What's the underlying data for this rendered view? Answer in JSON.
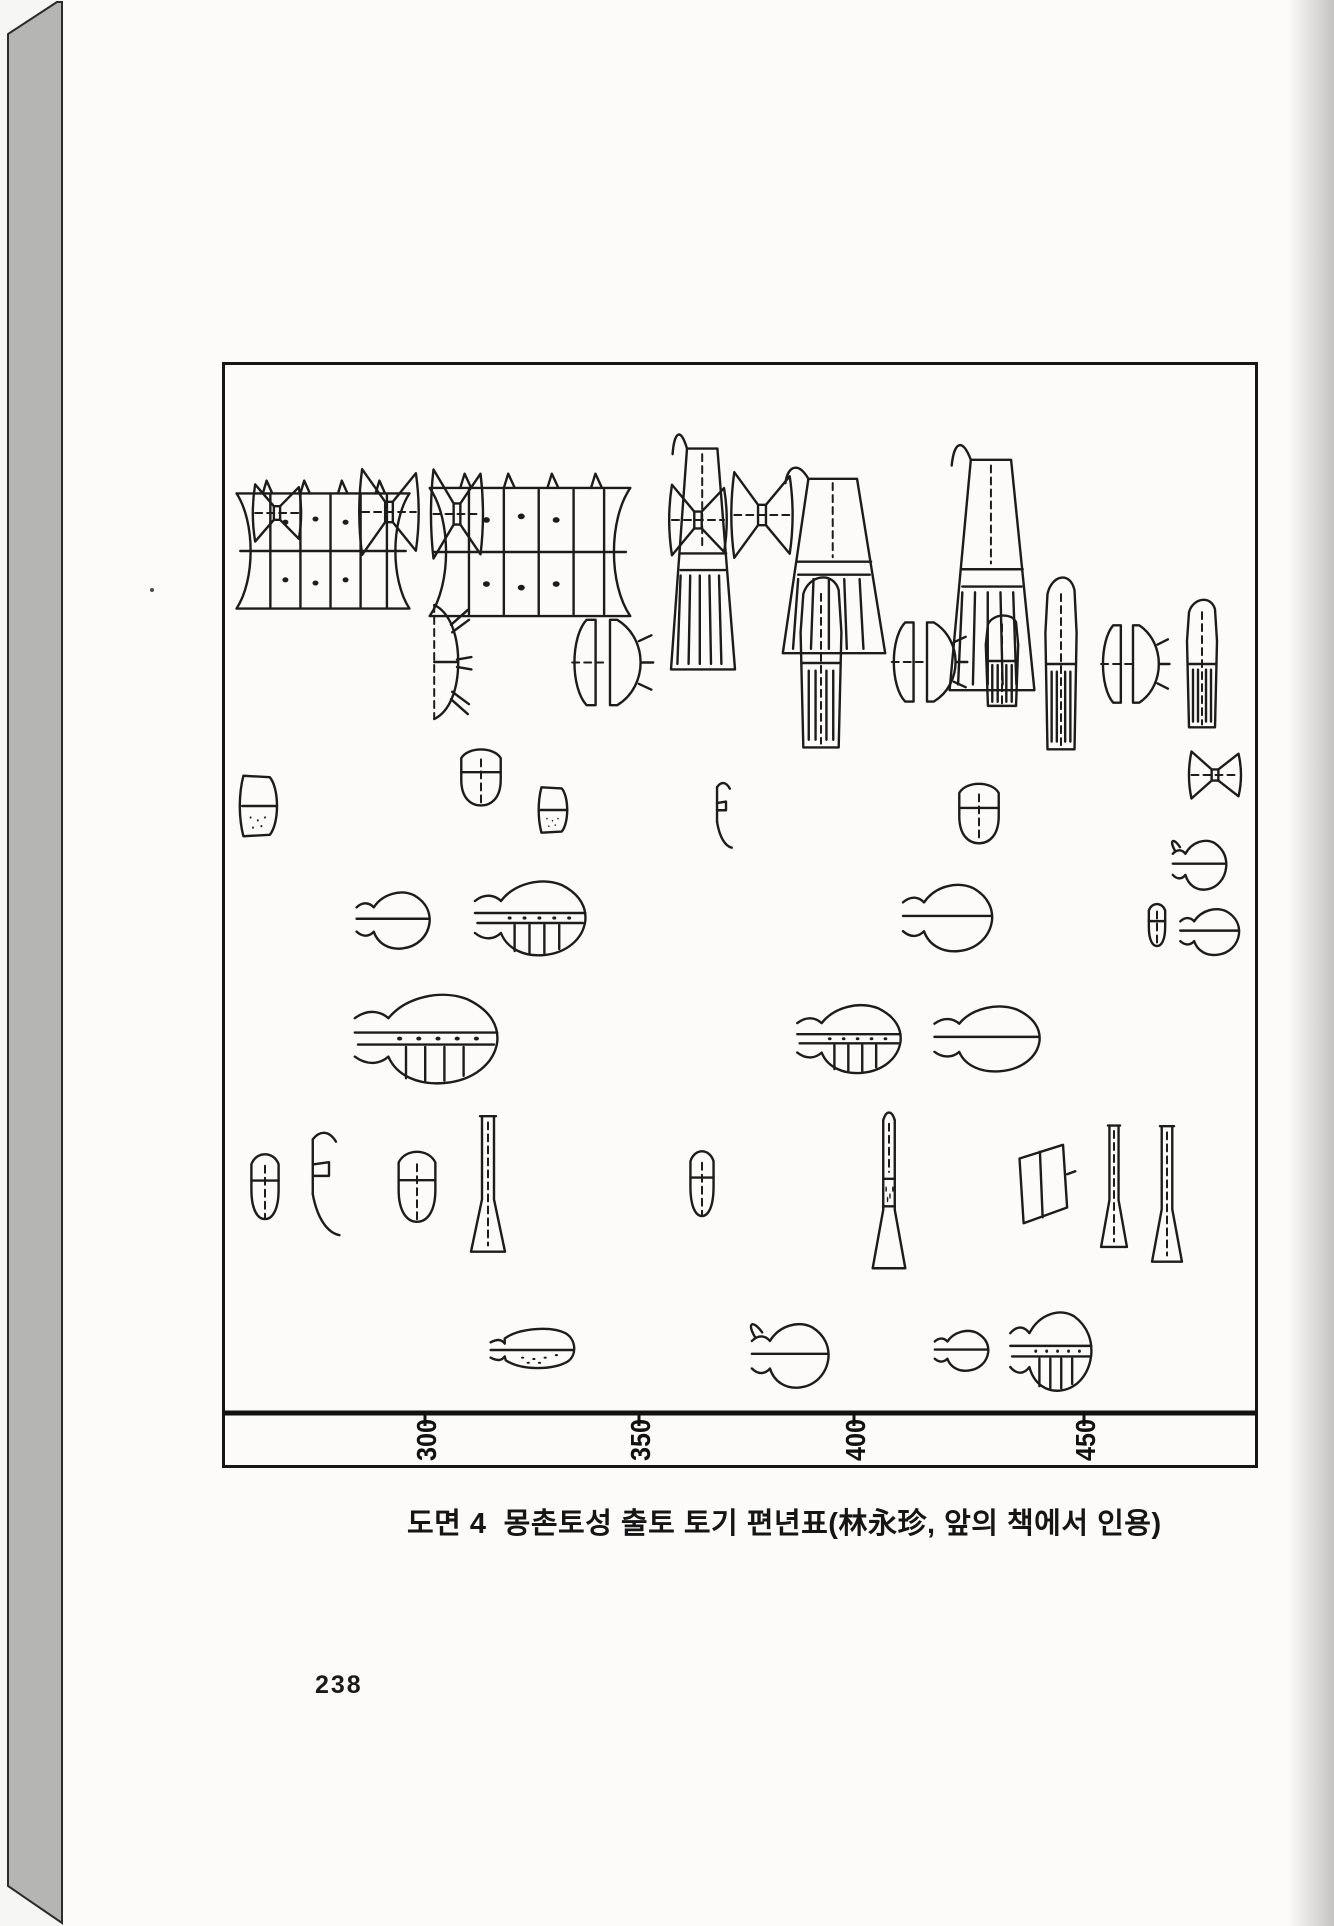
{
  "page": {
    "number": "238"
  },
  "figure": {
    "caption": "도면 4  몽촌토성 출토 토기 편년표(林永珍, 앞의 책에서 인용)",
    "axis": {
      "tick_labels": [
        "300",
        "350",
        "400",
        "450"
      ],
      "tick_x": [
        200,
        414,
        629,
        859
      ],
      "baseline_y": 1048,
      "tick_length": 13
    },
    "box": {
      "left": 222,
      "top": 362,
      "width": 1030,
      "height": 1100
    },
    "items": [
      {
        "t": "stand_long",
        "x": 4,
        "y": 106,
        "w": 188,
        "h": 160
      },
      {
        "t": "stand_long",
        "x": 196,
        "y": 98,
        "w": 218,
        "h": 178
      },
      {
        "t": "stand_cone",
        "x": 438,
        "y": 56,
        "w": 80,
        "h": 276
      },
      {
        "t": "stand_cone",
        "x": 545,
        "y": 92,
        "w": 128,
        "h": 218
      },
      {
        "t": "stand_cone",
        "x": 714,
        "y": 66,
        "w": 106,
        "h": 288
      },
      {
        "t": "goblet_bow",
        "x": 26,
        "y": 114,
        "w": 52,
        "h": 68
      },
      {
        "t": "goblet_bow",
        "x": 132,
        "y": 96,
        "w": 64,
        "h": 102
      },
      {
        "t": "goblet_bow",
        "x": 204,
        "y": 96,
        "w": 56,
        "h": 106
      },
      {
        "t": "goblet_bow",
        "x": 442,
        "y": 113,
        "w": 62,
        "h": 84
      },
      {
        "t": "goblet_bow",
        "x": 504,
        "y": 99,
        "w": 66,
        "h": 102
      },
      {
        "t": "dish_struts",
        "x": 190,
        "y": 235,
        "w": 60,
        "h": 124
      },
      {
        "t": "dish_half_pair",
        "x": 340,
        "y": 249,
        "w": 90,
        "h": 97
      },
      {
        "t": "deep_cyl",
        "x": 562,
        "y": 202,
        "w": 68,
        "h": 192
      },
      {
        "t": "dish_half_pair",
        "x": 660,
        "y": 252,
        "w": 84,
        "h": 90
      },
      {
        "t": "deep_cyl",
        "x": 750,
        "y": 245,
        "w": 54,
        "h": 102
      },
      {
        "t": "deep_cyl",
        "x": 810,
        "y": 202,
        "w": 52,
        "h": 194
      },
      {
        "t": "dish_half_pair",
        "x": 870,
        "y": 255,
        "w": 76,
        "h": 88
      },
      {
        "t": "deep_cyl",
        "x": 952,
        "y": 227,
        "w": 50,
        "h": 144
      },
      {
        "t": "goblet_bow",
        "x": 962,
        "y": 382,
        "w": 56,
        "h": 56
      },
      {
        "t": "bowl_hatch",
        "x": 10,
        "y": 405,
        "w": 60,
        "h": 72
      },
      {
        "t": "bowl_cup",
        "x": 227,
        "y": 379,
        "w": 58,
        "h": 64
      },
      {
        "t": "bowl_hatch",
        "x": 310,
        "y": 418,
        "w": 46,
        "h": 54
      },
      {
        "t": "lid_hook",
        "x": 485,
        "y": 415,
        "w": 32,
        "h": 72
      },
      {
        "t": "bowl_cup",
        "x": 725,
        "y": 413,
        "w": 58,
        "h": 68
      },
      {
        "t": "jar_handle",
        "x": 943,
        "y": 465,
        "w": 60,
        "h": 66
      },
      {
        "t": "jar_neck",
        "x": 125,
        "y": 515,
        "w": 82,
        "h": 76
      },
      {
        "t": "jar_hatched",
        "x": 240,
        "y": 500,
        "w": 124,
        "h": 100
      },
      {
        "t": "jar_neck",
        "x": 670,
        "y": 505,
        "w": 100,
        "h": 90
      },
      {
        "t": "bowl_cup",
        "x": 920,
        "y": 535,
        "w": 24,
        "h": 48
      },
      {
        "t": "jar_neck",
        "x": 950,
        "y": 534,
        "w": 66,
        "h": 62
      },
      {
        "t": "jar_hatched",
        "x": 117,
        "y": 610,
        "w": 160,
        "h": 120
      },
      {
        "t": "jar_hatched",
        "x": 563,
        "y": 625,
        "w": 116,
        "h": 92
      },
      {
        "t": "jar_neck",
        "x": 700,
        "y": 627,
        "w": 118,
        "h": 88
      },
      {
        "t": "bowl_cup",
        "x": 20,
        "y": 783,
        "w": 40,
        "h": 74
      },
      {
        "t": "lid_hook",
        "x": 75,
        "y": 763,
        "w": 58,
        "h": 114
      },
      {
        "t": "bowl_cup",
        "x": 165,
        "y": 780,
        "w": 54,
        "h": 80
      },
      {
        "t": "pedestal_flare",
        "x": 238,
        "y": 745,
        "w": 50,
        "h": 154
      },
      {
        "t": "bowl_cup",
        "x": 460,
        "y": 780,
        "w": 34,
        "h": 74
      },
      {
        "t": "pedestal_hatch",
        "x": 640,
        "y": 745,
        "w": 48,
        "h": 172
      },
      {
        "t": "dish_trap",
        "x": 785,
        "y": 770,
        "w": 68,
        "h": 98
      },
      {
        "t": "pedestal_flare",
        "x": 870,
        "y": 755,
        "w": 38,
        "h": 138
      },
      {
        "t": "pedestal_flare",
        "x": 920,
        "y": 755,
        "w": 44,
        "h": 154
      },
      {
        "t": "flask_side",
        "x": 260,
        "y": 953,
        "w": 94,
        "h": 64
      },
      {
        "t": "jar_handle",
        "x": 520,
        "y": 945,
        "w": 86,
        "h": 86
      },
      {
        "t": "jar_neck",
        "x": 705,
        "y": 957,
        "w": 60,
        "h": 54
      },
      {
        "t": "jar_hatched",
        "x": 778,
        "y": 930,
        "w": 91,
        "h": 106
      }
    ]
  },
  "colors": {
    "ink": "#1c1c1c",
    "page": "#fcfbf9",
    "book_edge": "#b5b5b4",
    "edge_outline": "#2b2b2b"
  }
}
